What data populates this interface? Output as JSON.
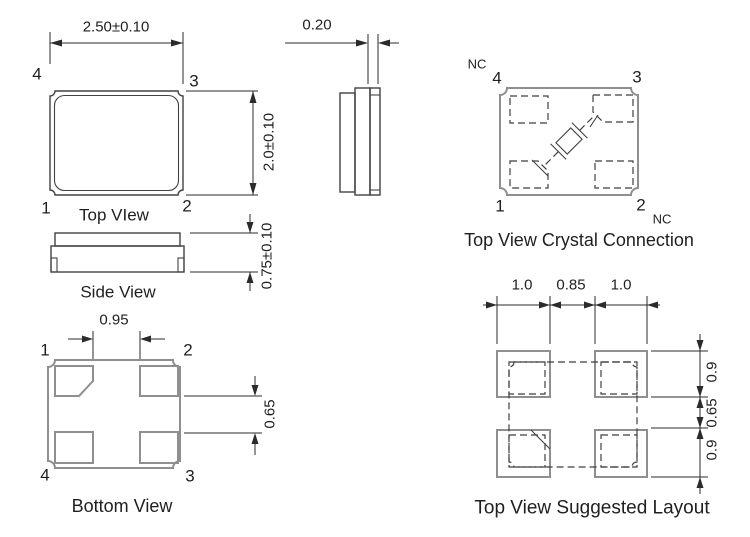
{
  "top_view": {
    "caption": "Top VIew",
    "width_dim": "2.50±0.10",
    "height_dim": "2.0±0.10",
    "pin_tl": "4",
    "pin_tr": "3",
    "pin_bl": "1",
    "pin_br": "2"
  },
  "side_profile": {
    "thickness_dim": "0.20"
  },
  "side_view": {
    "caption": "Side View",
    "height_dim": "0.75±0.10"
  },
  "bottom_view": {
    "caption": "Bottom View",
    "pad_gap_dim": "0.95",
    "pad_pitch_dim": "0.65",
    "pin_tl": "1",
    "pin_tr": "2",
    "pin_bl": "4",
    "pin_br": "3"
  },
  "crystal_connection": {
    "caption": "Top View Crystal Connection",
    "pin_tl": "4",
    "pin_tr": "3",
    "pin_bl": "1",
    "pin_br": "2",
    "nc_top_label": "NC",
    "nc_bottom_label": "NC"
  },
  "suggested_layout": {
    "caption": "Top View Suggested Layout",
    "dim_left": "1.0",
    "dim_center": "0.85",
    "dim_right": "1.0",
    "dim_top": "0.9",
    "dim_middle": "0.65",
    "dim_bottom": "0.9"
  },
  "colors": {
    "background": "#ffffff",
    "outline_dark": "#424242",
    "outline_gray": "#8f8f8f",
    "dimension": "#2b2b2b",
    "text": "#1f1f1f"
  }
}
